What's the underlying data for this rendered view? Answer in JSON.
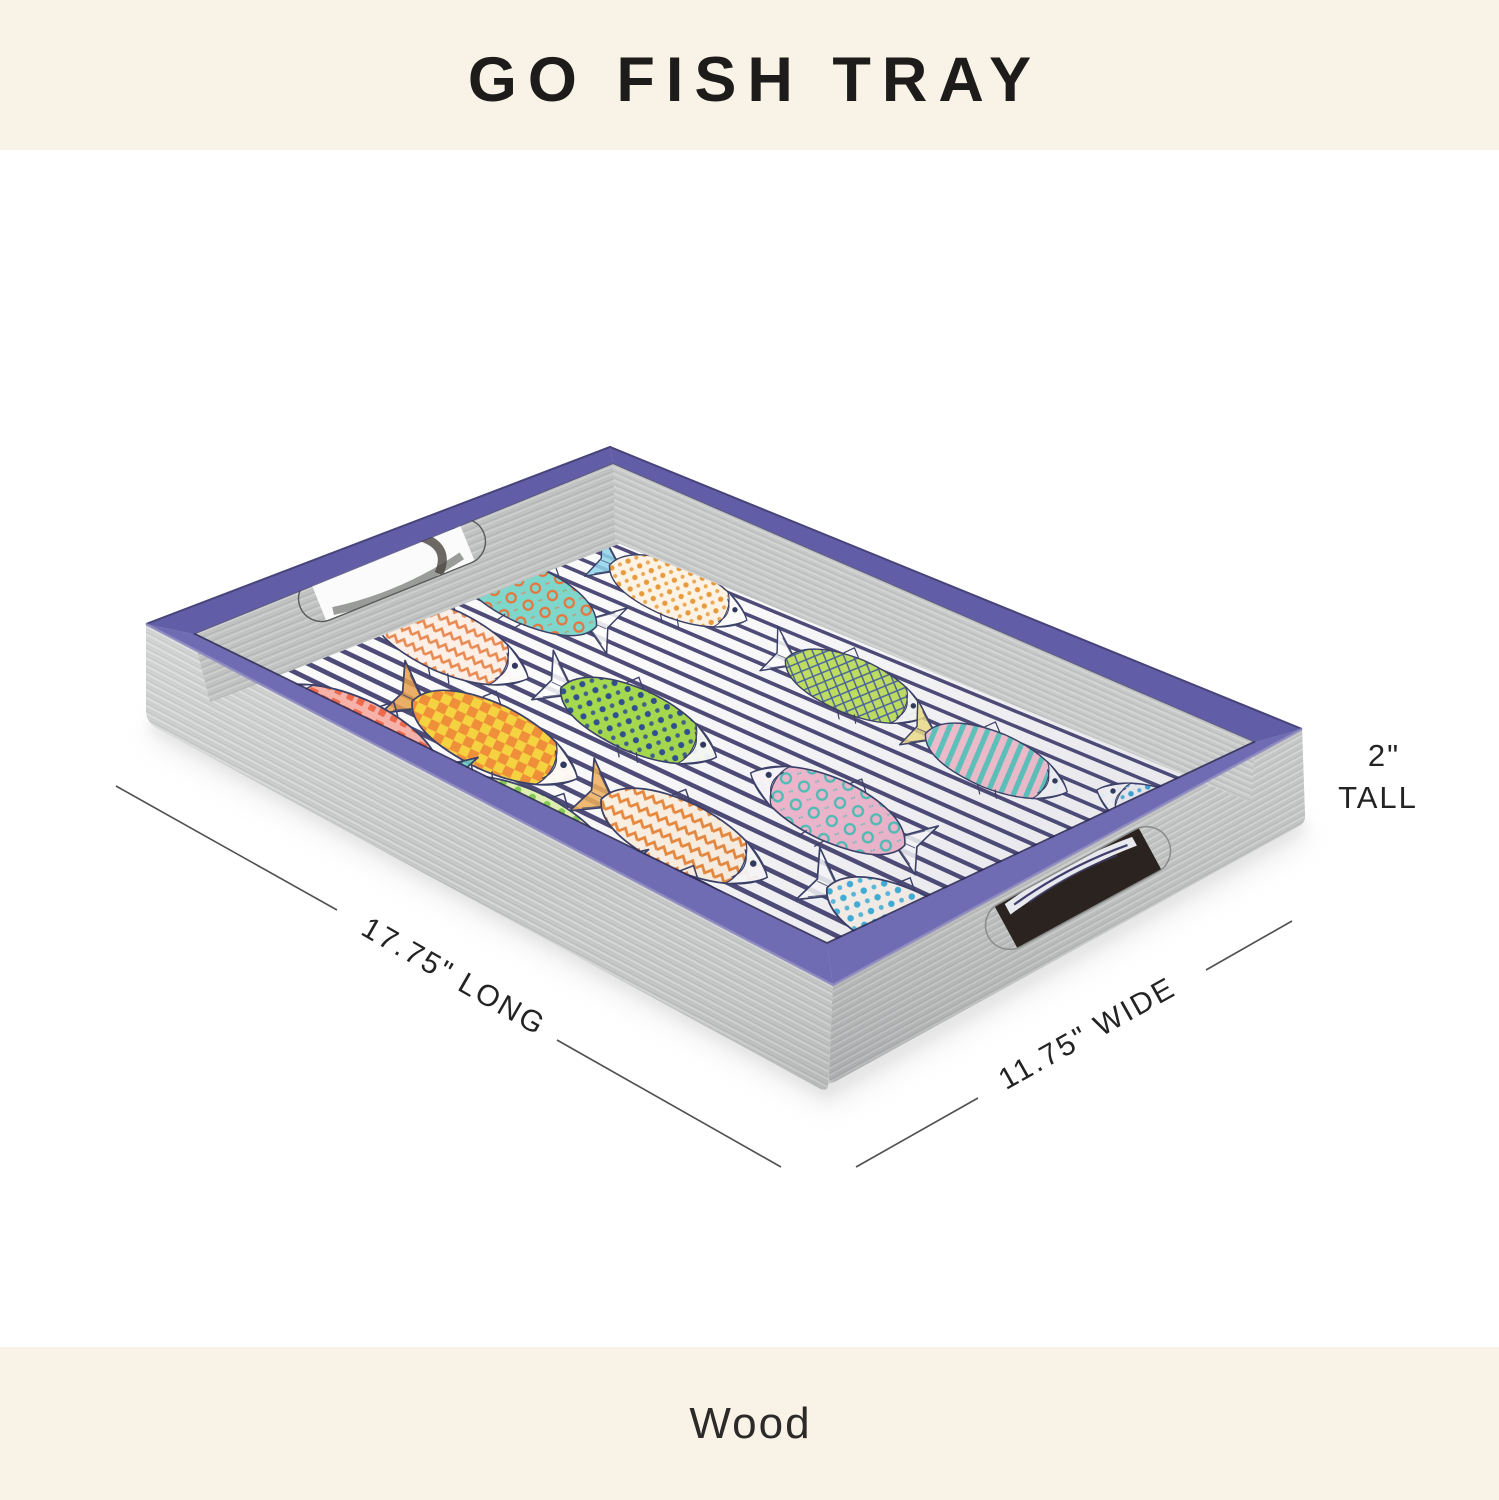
{
  "header": {
    "title": "GO FISH TRAY"
  },
  "footer": {
    "material": "Wood"
  },
  "dimensions": {
    "long": "17.75\" LONG",
    "wide": "11.75\" WIDE",
    "tall_value": "2\"",
    "tall_word": "TALL"
  },
  "tray": {
    "colors": {
      "rim_purple": "#6f6cb4",
      "rim_purple_dark": "#615ea7",
      "rim_lip": "#2e2b55",
      "rim_edge_dark": "#47447a",
      "wood_grey": "#c8cac9",
      "floor_white": "#fafafb",
      "stripe_navy": "#413e6e",
      "outline": "#3c4168",
      "banner_cream": "#f8f2e7",
      "handle_shadow": "#2a231f"
    },
    "stripe_count": 24,
    "fish": [
      {
        "u": 0.03,
        "v": 0.72,
        "dir": "L",
        "pattern": "rings",
        "c1": "#7fd6cb",
        "c2": "#e8743d"
      },
      {
        "u": 0.15,
        "v": 0.92,
        "dir": "R",
        "pattern": "dots",
        "c1": "#fdf3e4",
        "c2": "#e89b3c",
        "tail": "#8fd3ea"
      },
      {
        "u": 0.47,
        "v": 0.86,
        "dir": "R",
        "pattern": "crosshatch",
        "c1": "#c3e162",
        "c2": "#47629e"
      },
      {
        "u": 0.72,
        "v": 0.82,
        "dir": "R",
        "pattern": "stripes",
        "c1": "#f6c3d0",
        "c2": "#5fc8bf",
        "tail": "#f3e28a"
      },
      {
        "u": 0.96,
        "v": 0.86,
        "dir": "L",
        "pattern": "dots",
        "c1": "#f4f5f7",
        "c2": "#3aa9da"
      },
      {
        "u": 0.07,
        "v": 0.48,
        "dir": "R",
        "pattern": "chevron",
        "c1": "#fdeee6",
        "c2": "#e98a52",
        "tail": "#f0927e"
      },
      {
        "u": 0.36,
        "v": 0.5,
        "dir": "R",
        "pattern": "dots",
        "c1": "#a5d94e",
        "c2": "#2f4f8e"
      },
      {
        "u": 0.66,
        "v": 0.5,
        "dir": "L",
        "pattern": "rings",
        "c1": "#f3bacf",
        "c2": "#4fc2b9"
      },
      {
        "u": 0.28,
        "v": 0.27,
        "dir": "R",
        "pattern": "checker",
        "c1": "#f5d340",
        "c2": "#ef8f3a",
        "tail": "#e8a04c"
      },
      {
        "u": 0.6,
        "v": 0.25,
        "dir": "R",
        "pattern": "chevron",
        "c1": "#fdf2e3",
        "c2": "#ea8a3d",
        "tail": "#f0b05a"
      },
      {
        "u": 0.93,
        "v": 0.3,
        "dir": "R",
        "pattern": "dots",
        "c1": "#fef7ee",
        "c2": "#41b3dd"
      },
      {
        "u": 0.16,
        "v": 0.1,
        "dir": "L",
        "pattern": "mosaic",
        "c1": "#f6b2a9",
        "c2": "#ee6a4d",
        "tail": "#5fc8bf"
      },
      {
        "u": 0.45,
        "v": 0.08,
        "dir": "L",
        "pattern": "dots",
        "c1": "#dff0b2",
        "c2": "#84ca52",
        "tail": "#6fd2c6"
      },
      {
        "u": 0.74,
        "v": 0.06,
        "dir": "R",
        "pattern": "checker",
        "c1": "#f2cc3d",
        "c2": "#ef9140",
        "tail": "#6fc9e0"
      }
    ]
  }
}
